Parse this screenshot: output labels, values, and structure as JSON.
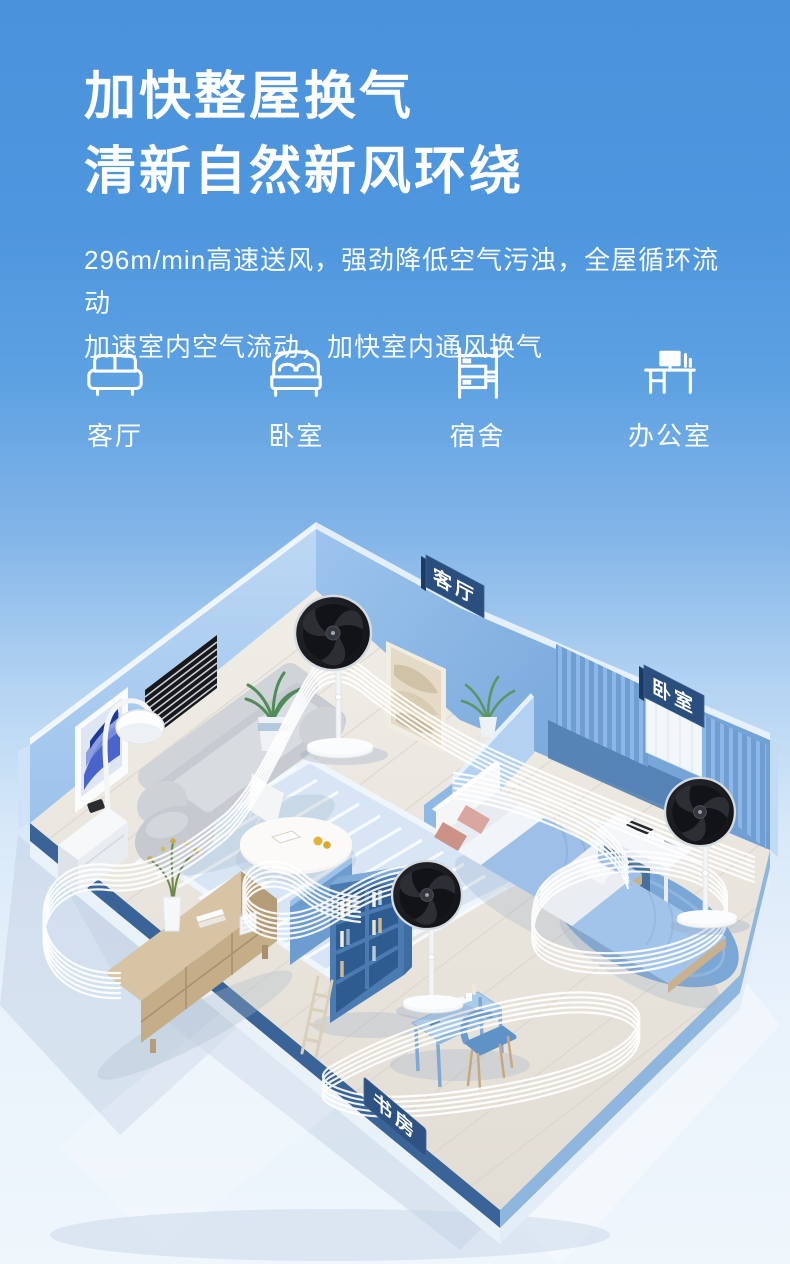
{
  "hero": {
    "title_line1": "加快整屋换气",
    "title_line2": "清新自然新风环绕",
    "subtitle_line1": "296m/min高速送风，强劲降低空气污浊，全屋循环流动",
    "subtitle_line2": "加速室内空气流动，加快室内通风换气"
  },
  "scenes": [
    {
      "icon": "sofa-icon",
      "label": "客厅"
    },
    {
      "icon": "double-bed-icon",
      "label": "卧室"
    },
    {
      "icon": "bunk-bed-icon",
      "label": "宿舍"
    },
    {
      "icon": "office-desk-icon",
      "label": "办公室"
    }
  ],
  "room_labels": {
    "living_room": "客厅",
    "bedroom": "卧室",
    "study": "书房"
  },
  "colors": {
    "background_top": "#4a92db",
    "background_bottom": "#eff6fc",
    "text": "#ffffff",
    "sign_navy": "#2a4e7d",
    "wall_blue_light": "#a9cdef",
    "wall_blue_deep": "#6f9ed3",
    "airflow": "#ffffff",
    "fan_head": "#17181b"
  }
}
